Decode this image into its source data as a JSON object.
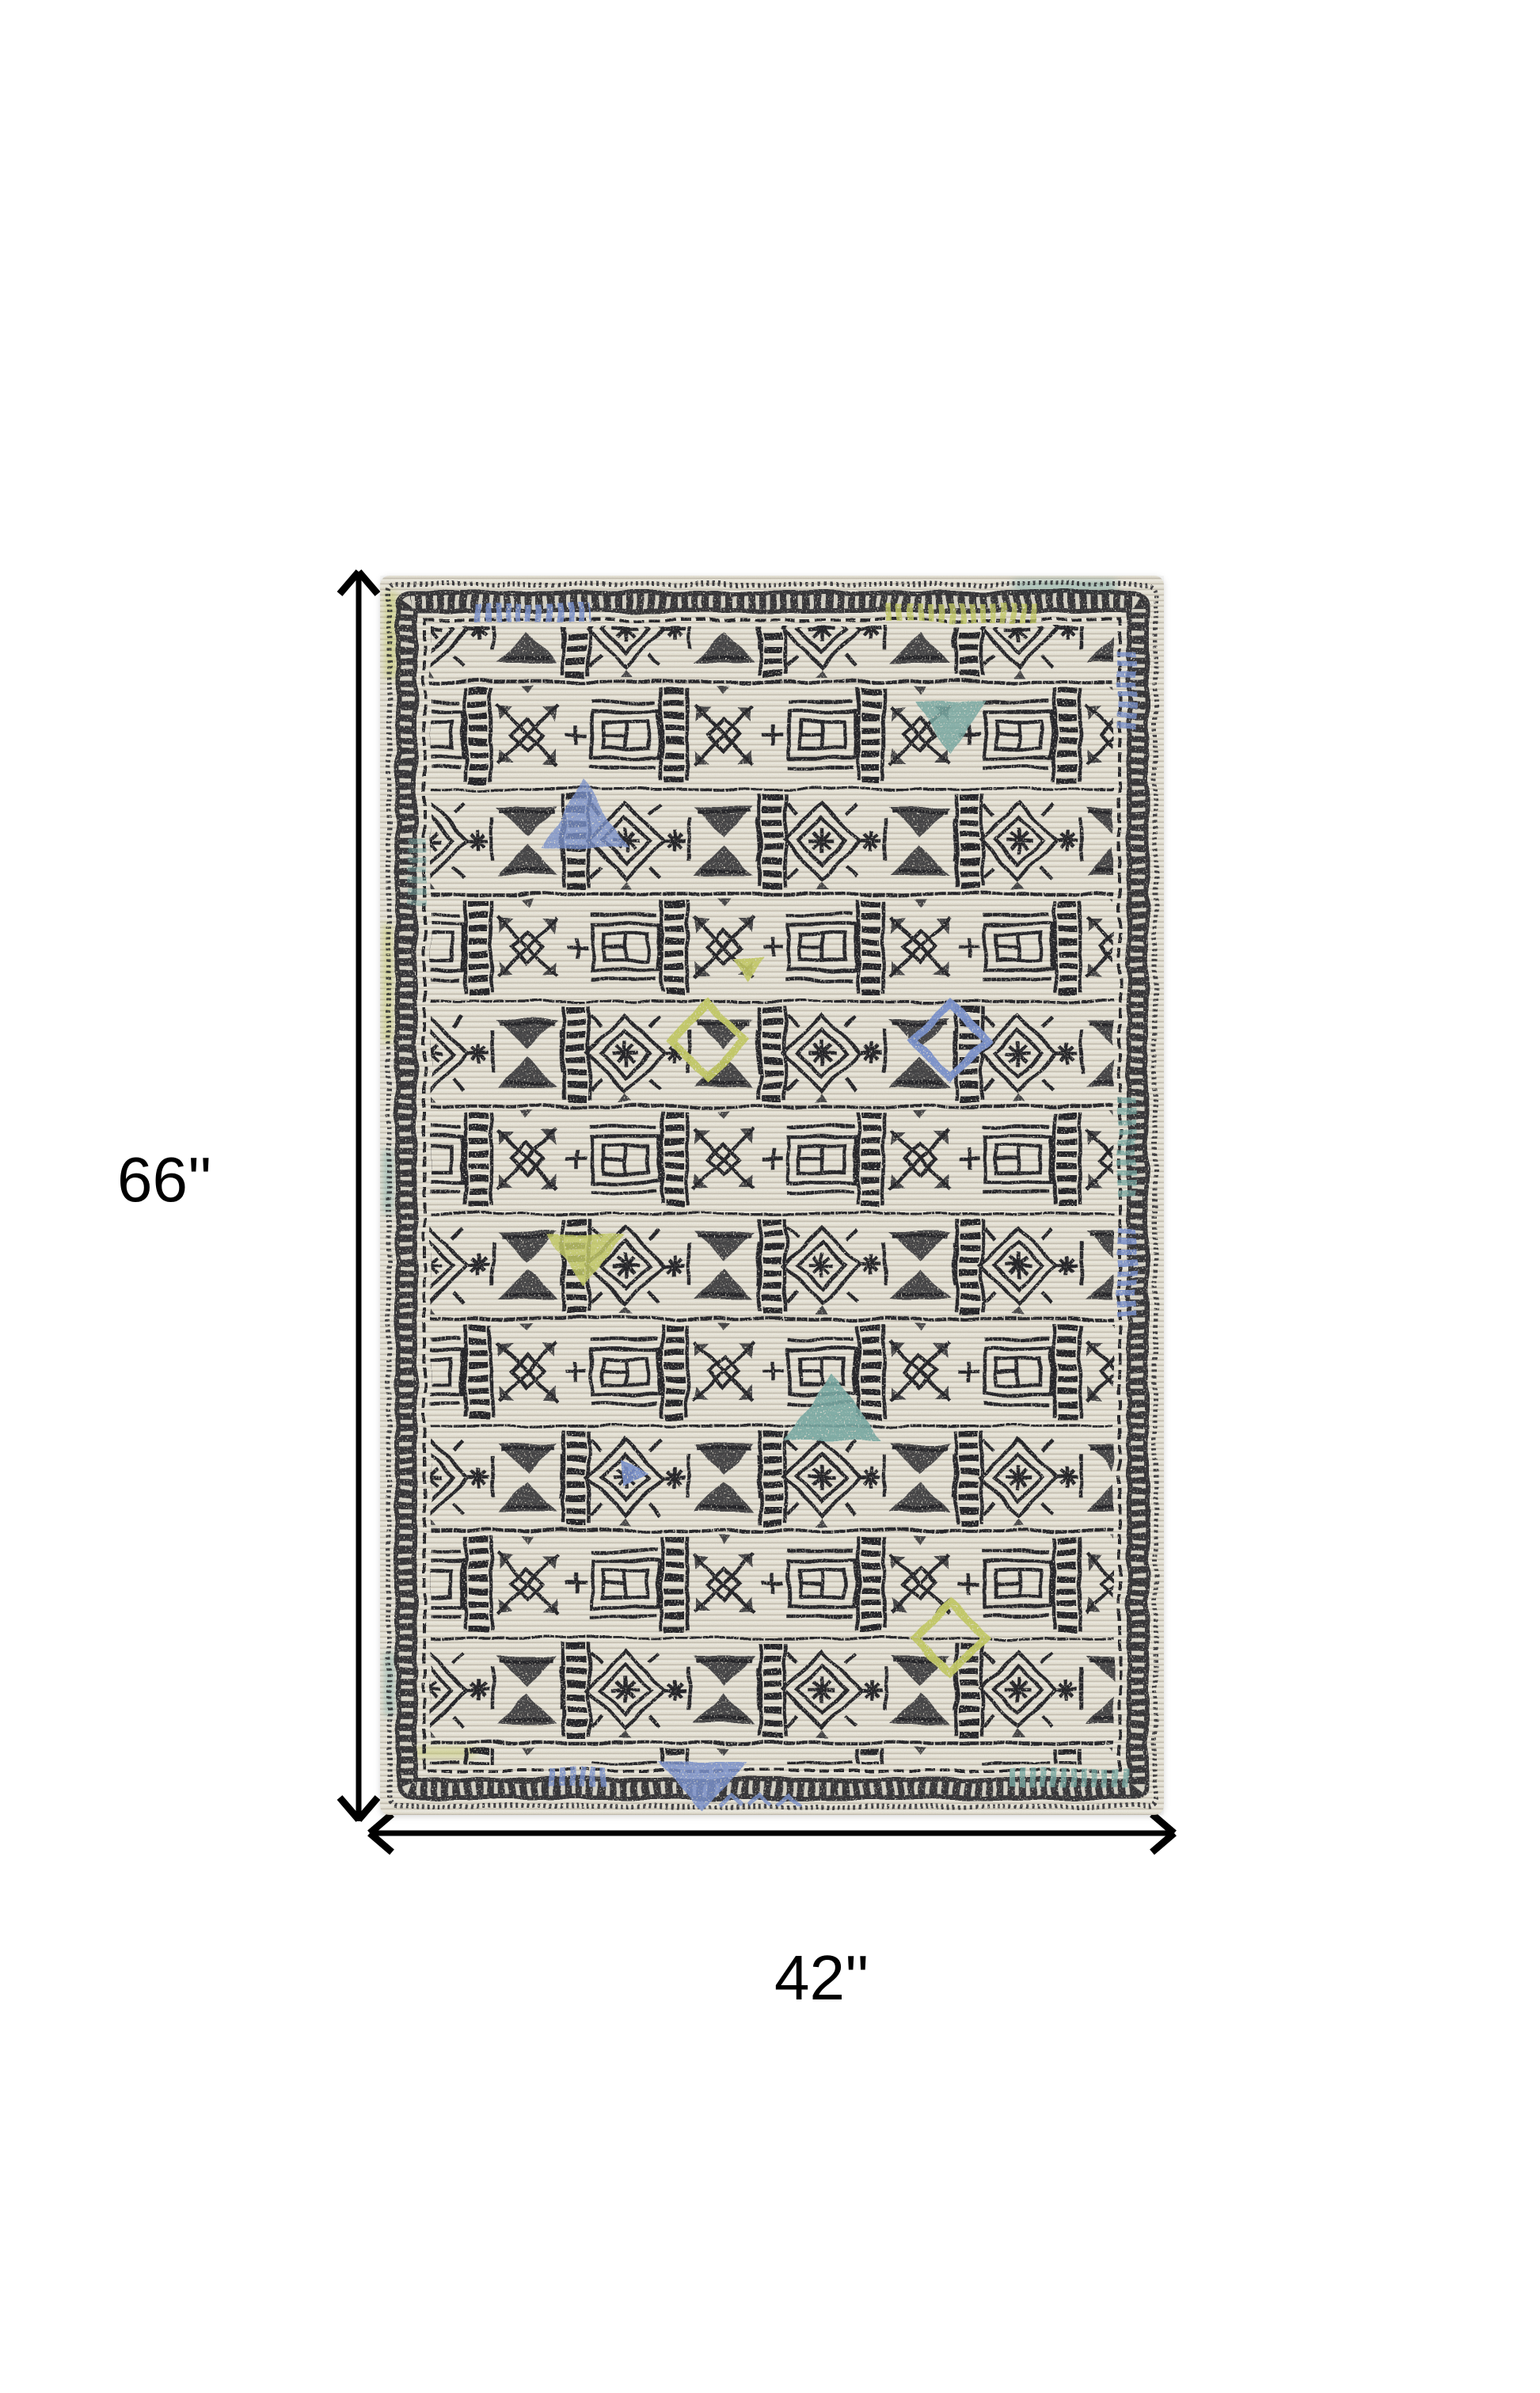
{
  "annotation": {
    "height_label": "66''",
    "width_label": "42''",
    "arrow_color": "#000000"
  },
  "rug": {
    "description": "Distressed tribal geometric area rug in ivory and charcoal with blue, teal and citron accents",
    "colors": {
      "base": "#e9e5d8",
      "ink": "#26262c",
      "blue": "#7c94d0",
      "teal": "#7aaca6",
      "green": "#c6cc67"
    }
  }
}
